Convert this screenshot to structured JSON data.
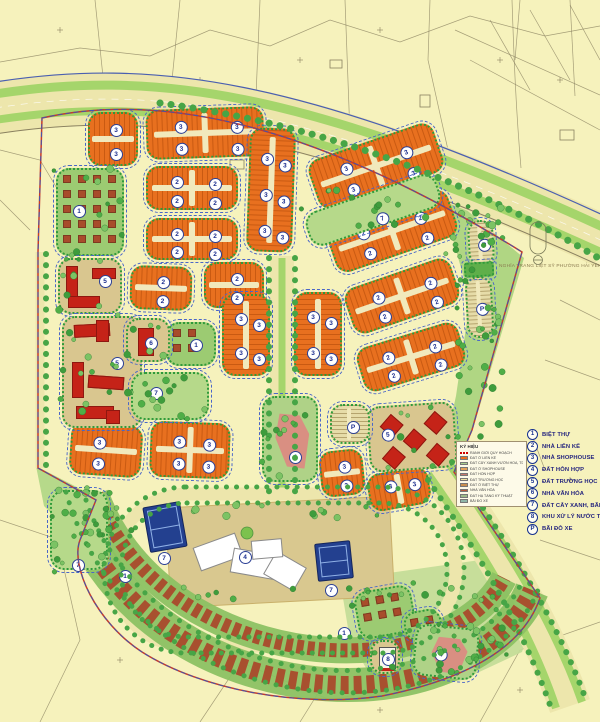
{
  "legend": {
    "items": [
      {
        "symbol": "1",
        "label": "BIỆT THỰ"
      },
      {
        "symbol": "2",
        "label": "NHÀ LIÊN KẾ"
      },
      {
        "symbol": "3",
        "label": "NHÀ SHOPHOUSE"
      },
      {
        "symbol": "4",
        "label": "ĐẤT HỖN HỢP"
      },
      {
        "symbol": "5",
        "label": "ĐẤT TRƯỜNG HỌC"
      },
      {
        "symbol": "6",
        "label": "NHÀ VĂN HÓA"
      },
      {
        "symbol": "7",
        "label": "ĐẤT CÂY XANH, BÃI ĐỖ XE"
      },
      {
        "symbol": "8",
        "label": "KHU XỬ LÝ NƯỚC THẢI"
      },
      {
        "symbol": "P",
        "label": "BÃI ĐỖ XE"
      }
    ]
  },
  "mini_legend": {
    "title": "KÝ HIỆU",
    "boundary_label": "RANH GIỚI QUY HOẠCH",
    "items": [
      {
        "color": "#E8701F",
        "label": "ĐẤT Ở LIỀN KỀ"
      },
      {
        "color": "#A9CF8E",
        "label": "ĐẤT CÂY XANH VƯỜN HOA, TDTT"
      },
      {
        "color": "#E2A25C",
        "label": "ĐẤT Ở SHOPHOUSE"
      },
      {
        "color": "#C9776B",
        "label": "ĐẤT HỖN HỢP"
      },
      {
        "color": "#F0E3A2",
        "label": "ĐẤT TRƯỜNG HỌC"
      },
      {
        "color": "#C98F4F",
        "label": "ĐẤT Ở BIỆT THỰ"
      },
      {
        "color": "#B2583C",
        "label": "NHÀ VĂN HÓA"
      },
      {
        "color": "#9DB98A",
        "label": "ĐẤT HẠ TẦNG KỸ THUẬT"
      },
      {
        "color": "#8FB6A8",
        "label": "BÃI ĐỖ XE"
      }
    ]
  },
  "map_labels": {
    "cemetery": "NGHĨA TRANG LIỆT SỸ PHƯỜNG HẢI YẾN"
  },
  "colors": {
    "background": "#F6F2BC",
    "row_housing": "#E8701F",
    "villa": "#A84C2B",
    "school": "#D9C68F",
    "building_red": "#C52318",
    "mixed_pink": "#D98F82",
    "park_green": "#B6D98A",
    "tree_green": "#46A33F",
    "court_navy": "#23408F",
    "road": "#EDE6AC",
    "median_green": "#A5D56B",
    "boundary_red": "#C23B2E",
    "boundary_blue": "#3B57B5",
    "chip_blue": "#2B3F95"
  }
}
